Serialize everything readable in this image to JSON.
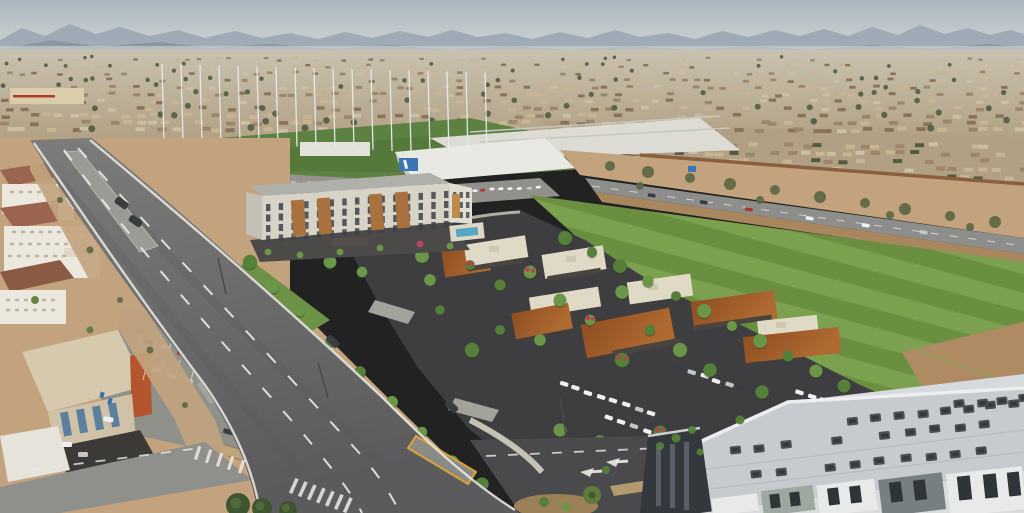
{
  "scene": {
    "title": "Aerial rendering - suburban mixed-use development with hotel, retail village, driving range and arterial road",
    "setting": "Sunny desert suburb, hazy mountain ranges on the horizon",
    "regions": [
      {
        "name": "sky-and-mountains",
        "label": "Hazy sky over distant mountain ranges"
      },
      {
        "name": "city-sprawl",
        "label": "Low-rise suburban sprawl with tan rooftops and dark trees"
      },
      {
        "name": "driving-range",
        "label": "Golf driving range with tall white netting poles, turf and parking garage"
      },
      {
        "name": "big-box-retail",
        "label": "White big-box buildings, one with a blue storefront sign"
      },
      {
        "name": "highway-corridor",
        "label": "Road behind desert landscaping and a rust screen wall with traffic"
      },
      {
        "name": "green-field",
        "label": "Large mowed green field with diagonal stripes and bare dirt patch"
      },
      {
        "name": "hotel",
        "label": "Five-story hotel with wood-tone accent panels, amber sign and pool"
      },
      {
        "name": "retail-village",
        "label": "Single-story retail pavilions with corten-rust and cream roofs, flowering trees"
      },
      {
        "name": "parking-lots",
        "label": "Fresh dark asphalt parking lots with rows of parked cars"
      },
      {
        "name": "main-road",
        "label": "Wide curving avenue with lane stripes, medians, crosswalks and a few cars"
      },
      {
        "name": "left-properties",
        "label": "Existing tile-roof hotel, orange-accent office building and surface parking"
      },
      {
        "name": "apartment-roof",
        "label": "Flat gray apartment roof with rooftop HVAC units in the foreground"
      }
    ]
  },
  "palette": {
    "sky_top": "#a9b6c0",
    "sky_bottom": "#d6dad6",
    "haze": "#ccd2cf",
    "mountain_far": "#9aa6b2",
    "mountain_near": "#83919f",
    "city_top": "#c9c1b0",
    "city_bottom": "#b1a083",
    "roof_tan": "#c9b592",
    "roof_brown": "#9c8568",
    "roof_dark": "#8a7258",
    "roof_pale": "#cbbfa4",
    "tree_dark": "#515c41",
    "bigbox_wall": "#dbcda9",
    "bigbox_stripe": "#b03a2e",
    "range_green": "#5d8140",
    "range_green_dark": "#4f7136",
    "pole": "#e7ebee",
    "white_building": "#e9e9e4",
    "building_shadow": "#c3c6c5",
    "garage_band": "#aeb4b6",
    "warehouse": "#dcdbd4",
    "sign_blue": "#3d74b4",
    "desert": "#c2a37e",
    "desert_dark": "#a8875f",
    "shrub": "#5d6742",
    "wall_rust": "#8a5f3e",
    "highway": "#8d8d8b",
    "field_green_a": "#6b8f41",
    "field_green_b": "#7ba04e",
    "dirt": "#b08a63",
    "parcel_asphalt": "#3e3e40",
    "road_top": "#7c7c7a",
    "road_bottom": "#5b5b5d",
    "road_new": "#4a4a4c",
    "lot_gray": "#90908a",
    "drive_gray": "#a3a39c",
    "lane_white": "#eceae4",
    "median_yellow": "#d9a33c",
    "median_gray": "#9b9b95",
    "sidewalk": "#cdc8bb",
    "hotel_wall": "#d8d3c7",
    "hotel_wall_light": "#e2ded4",
    "hotel_wall_shade": "#c5c0b5",
    "hotel_roof": "#b0b0aa",
    "hotel_wood": "#a9713d",
    "hotel_sign_amber": "#c08a4a",
    "window_dark": "#3b424a",
    "pool_blue": "#57a7c4",
    "pool_deck": "#ded7c4",
    "rust_roof": "#8f4e22",
    "rust_roof_light": "#b06a31",
    "cream_roof": "#e0d9c5",
    "cream_roof_shade": "#cfc7b1",
    "storefront": "#4a443e",
    "tree_green": "#55803a",
    "tree_green_light": "#6b9547",
    "bloom_red": "#c23a4e",
    "tile_roof": "#9a6450",
    "tile_roof_dark": "#8a5a44",
    "stucco": "#ece8de",
    "office_tan": "#d6c9ad",
    "office_orange": "#b4552d",
    "glass_blue": "#5b7f9c",
    "canopy_dark": "#3c3a36",
    "lawn": "#6d9245",
    "apt_roof": "#c7cbd0",
    "apt_roof_light": "#d6dadd",
    "apt_parapet": "#eceef0",
    "apt_dark": "#34383c",
    "hvac": "#4a4f54",
    "hvac_dark": "#35393d",
    "panel_sage": "#9fa8a0",
    "panel_gray": "#787f83",
    "panel_white": "#e8eae9",
    "car_white": "#eef0f1",
    "car_silver": "#c3c7ca",
    "car_dark": "#3a3d40",
    "car_red": "#b03530",
    "palm": "#5d7a3b",
    "palm_dark": "#3f5530",
    "planter_tan": "#9c8057",
    "accent_shrub_red": "#b5485c",
    "handicap_blue": "#3a6fae"
  }
}
